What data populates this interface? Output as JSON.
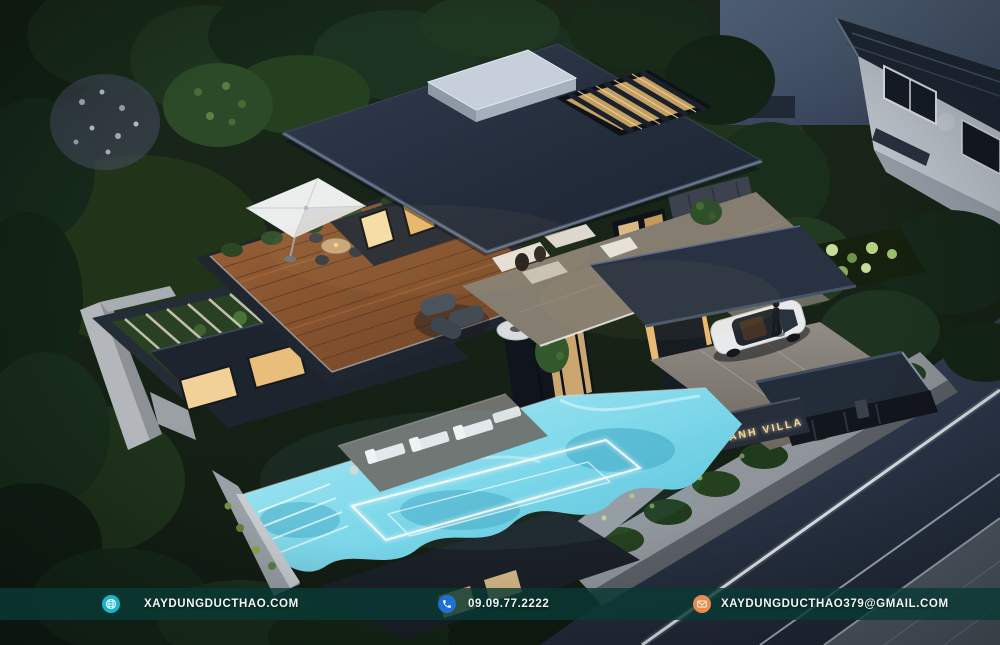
{
  "scene": {
    "description": "Night aerial 3D render of a modern two-storey villa with rooftop terrace, glowing infinity pool, driveway and gated entrance",
    "gate_sign": "HOANG ANH VILLA"
  },
  "footer": {
    "bar_color": "rgba(9,58,52,0.8)",
    "website": {
      "label": "XAYDUNGDUCTHAO.COM",
      "icon": "globe-icon",
      "icon_color": "#17b4cd"
    },
    "phone": {
      "label": "09.09.77.2222",
      "icon": "phone-icon",
      "icon_color": "#1e6fd6"
    },
    "email": {
      "label": "XAYDUNGDUCTHAO379@GMAIL.COM",
      "icon": "mail-icon",
      "icon_color": "#ee8a4b"
    }
  },
  "colors": {
    "pool_water": "#7ed8ea",
    "roof_slate": "#252e3d",
    "wood_deck": "#8a5532",
    "window_glow": "#f2d49a",
    "garden_dark": "#16241a",
    "sky_dusk": "#4e5d70"
  }
}
